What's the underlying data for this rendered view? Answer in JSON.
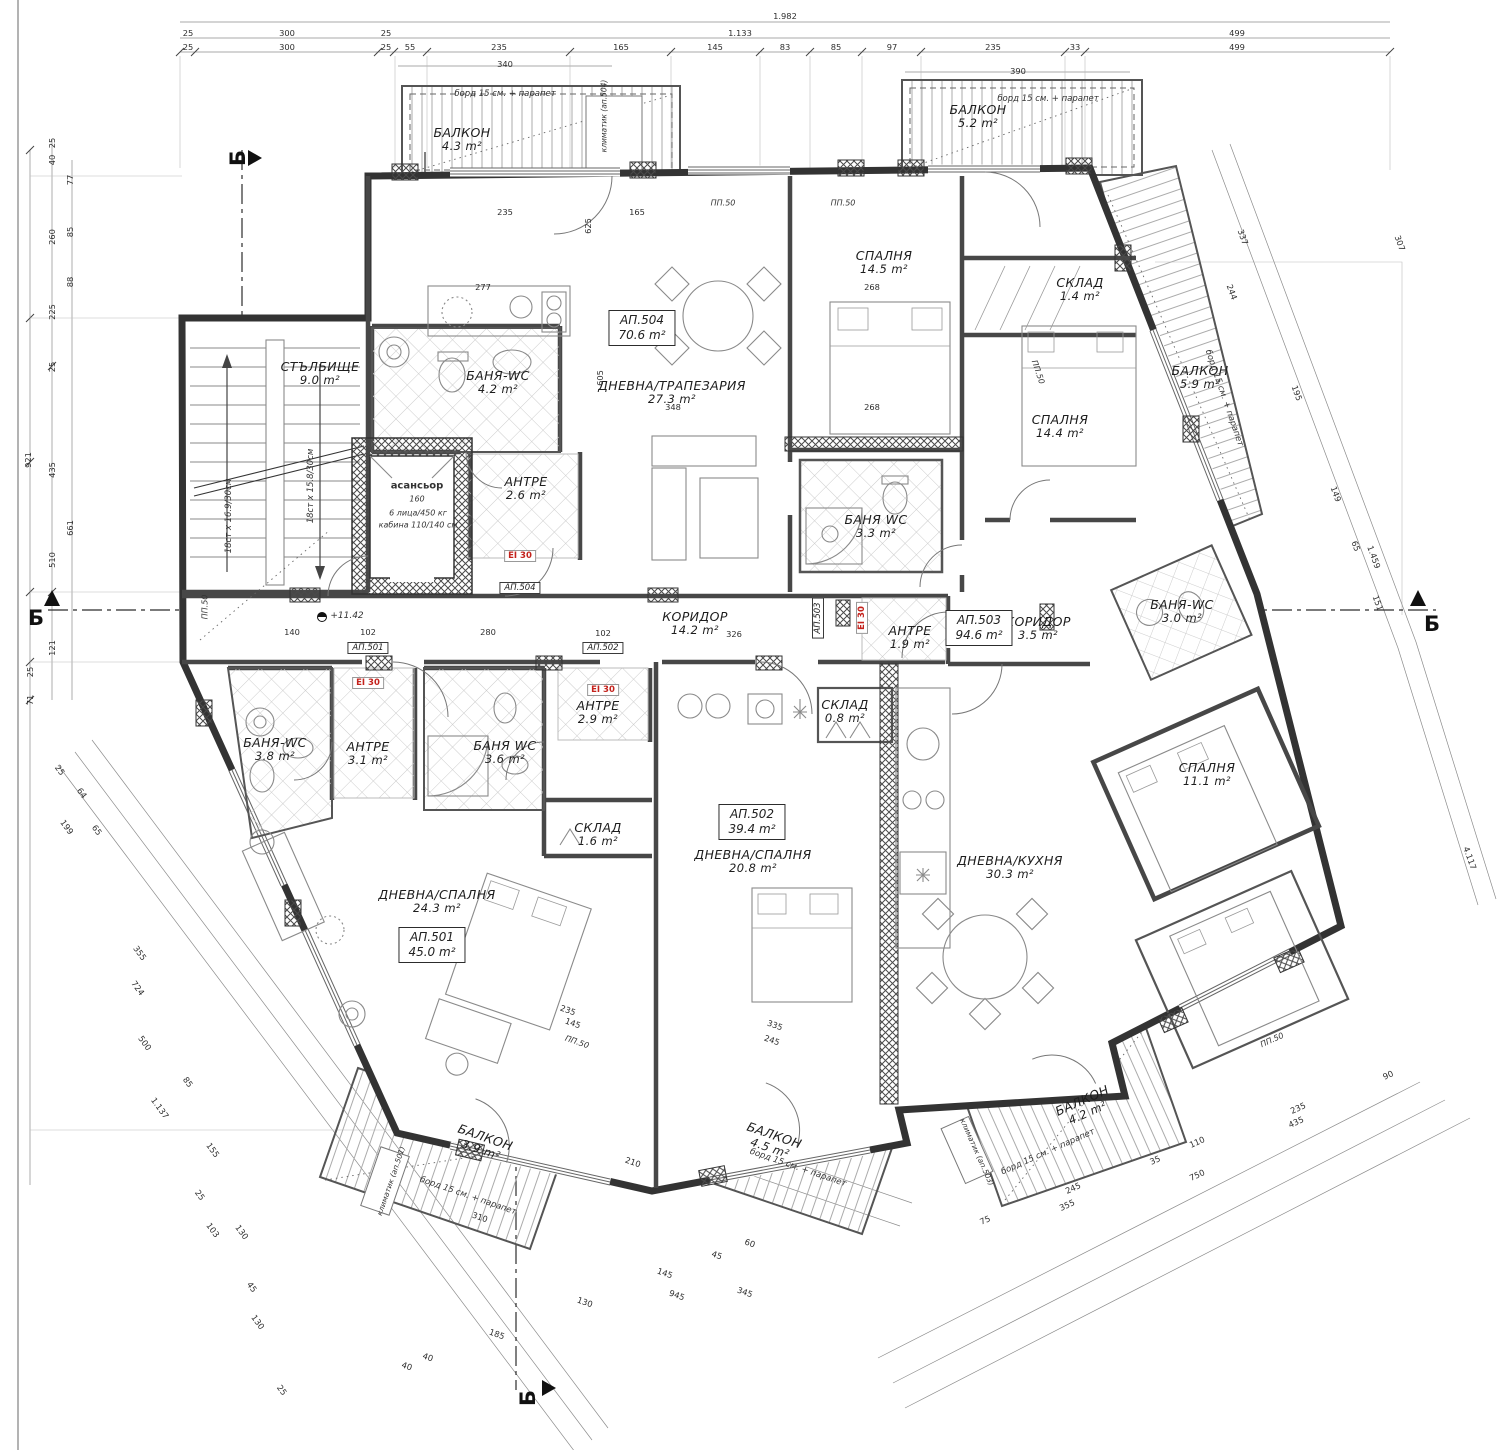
{
  "meta": {
    "section_label": "Б",
    "fire": "EI 30",
    "level": "+11.42",
    "colors": {
      "fire_red": "#c4231d",
      "wall": "#333333",
      "hatch": "#aaaaaa"
    }
  },
  "rooms": [
    {
      "n": "БАЛКОН",
      "a": "4.3 m²",
      "x": 462,
      "y": 140,
      "r": 0
    },
    {
      "n": "БАЛКОН",
      "a": "5.2 m²",
      "x": 978,
      "y": 117,
      "r": 0
    },
    {
      "n": "БАЛКОН",
      "a": "5.9 m²",
      "x": 1200,
      "y": 378,
      "r": 0
    },
    {
      "n": "СТЪЛБИЩЕ",
      "a": "9.0 m²",
      "x": 320,
      "y": 374,
      "r": 0
    },
    {
      "n": "БАНЯ-WC",
      "a": "4.2 m²",
      "x": 498,
      "y": 383,
      "r": 0
    },
    {
      "n": "АНТРЕ",
      "a": "2.6 m²",
      "x": 526,
      "y": 489,
      "r": 0
    },
    {
      "n": "ДНЕВНА/ТРАПЕЗАРИЯ",
      "a": "27.3 m²",
      "x": 672,
      "y": 393,
      "r": 0
    },
    {
      "n": "СПАЛНЯ",
      "a": "14.5 m²",
      "x": 884,
      "y": 263,
      "r": 0
    },
    {
      "n": "СКЛАД",
      "a": "1.4 m²",
      "x": 1080,
      "y": 290,
      "r": 0
    },
    {
      "n": "СПАЛНЯ",
      "a": "14.4 m²",
      "x": 1060,
      "y": 427,
      "r": 0
    },
    {
      "n": "БАНЯ WC",
      "a": "3.3 m²",
      "x": 876,
      "y": 527,
      "r": 0
    },
    {
      "n": "КОРИДОР",
      "a": "14.2 m²",
      "x": 695,
      "y": 624,
      "r": 0
    },
    {
      "n": "АНТРЕ",
      "a": "1.9 m²",
      "x": 910,
      "y": 638,
      "r": 0
    },
    {
      "n": "КОРИДОР",
      "a": "3.5 m²",
      "x": 1038,
      "y": 629,
      "r": 0
    },
    {
      "n": "БАНЯ-WC",
      "a": "3.0 m²",
      "x": 1182,
      "y": 612,
      "r": 0
    },
    {
      "n": "СПАЛНЯ",
      "a": "11.1 m²",
      "x": 1207,
      "y": 775,
      "r": 0
    },
    {
      "n": "ДНЕВНА/КУХНЯ",
      "a": "30.3 m²",
      "x": 1010,
      "y": 868,
      "r": 0
    },
    {
      "n": "СКЛАД",
      "a": "0.8 m²",
      "x": 845,
      "y": 712,
      "r": 0
    },
    {
      "n": "ДНЕВНА/СПАЛНЯ",
      "a": "20.8 m²",
      "x": 753,
      "y": 862,
      "r": 0
    },
    {
      "n": "СКЛАД",
      "a": "1.6 m²",
      "x": 598,
      "y": 835,
      "r": 0
    },
    {
      "n": "АНТРЕ",
      "a": "2.9 m²",
      "x": 598,
      "y": 713,
      "r": 0
    },
    {
      "n": "БАНЯ WC",
      "a": "3.6 m²",
      "x": 505,
      "y": 753,
      "r": 0
    },
    {
      "n": "АНТРЕ",
      "a": "3.1 m²",
      "x": 368,
      "y": 754,
      "r": 0
    },
    {
      "n": "БАНЯ-WC",
      "a": "3.8 m²",
      "x": 275,
      "y": 750,
      "r": 0
    },
    {
      "n": "ДНЕВНА/СПАЛНЯ",
      "a": "24.3 m²",
      "x": 437,
      "y": 902,
      "r": 0
    },
    {
      "n": "БАЛКОН",
      "a": "3.9 m²",
      "x": 483,
      "y": 1144,
      "r": 19
    },
    {
      "n": "БАЛКОН",
      "a": "4.5 m²",
      "x": 772,
      "y": 1142,
      "r": 19
    },
    {
      "n": "БАЛКОН",
      "a": "4.2 m²",
      "x": 1085,
      "y": 1107,
      "r": -24
    }
  ],
  "apartments": [
    {
      "id": "АП.504",
      "a": "70.6 m²",
      "x": 642,
      "y": 328
    },
    {
      "id": "АП.503",
      "a": "94.6 m²",
      "x": 979,
      "y": 628
    },
    {
      "id": "АП.502",
      "a": "39.4 m²",
      "x": 752,
      "y": 822
    },
    {
      "id": "АП.501",
      "a": "45.0 m²",
      "x": 432,
      "y": 945
    }
  ],
  "tags": [
    {
      "t": "АП.501",
      "x": 368,
      "y": 648,
      "r": 0
    },
    {
      "t": "АП.502",
      "x": 603,
      "y": 648,
      "r": 0
    },
    {
      "t": "АП.504",
      "x": 520,
      "y": 588,
      "r": 0
    },
    {
      "t": "АП.503",
      "x": 818,
      "y": 618,
      "r": -90
    }
  ],
  "fire_marks": [
    {
      "x": 520,
      "y": 556,
      "r": 0
    },
    {
      "x": 368,
      "y": 683,
      "r": 0
    },
    {
      "x": 603,
      "y": 690,
      "r": 0
    },
    {
      "x": 862,
      "y": 618,
      "r": -90
    }
  ],
  "sections": [
    {
      "x": 36,
      "y": 618,
      "r": 0
    },
    {
      "x": 1432,
      "y": 624,
      "r": 0
    },
    {
      "x": 238,
      "y": 158,
      "r": -90
    },
    {
      "x": 528,
      "y": 1398,
      "r": -90
    }
  ],
  "notes": [
    {
      "t": "борд 15 см. + парапет",
      "x": 505,
      "y": 94,
      "r": 0,
      "s": 8.5
    },
    {
      "t": "борд 15 см. + парапет",
      "x": 1048,
      "y": 99,
      "r": 0,
      "s": 8.5
    },
    {
      "t": "борд 15 см. + парапет",
      "x": 1224,
      "y": 398,
      "r": 71,
      "s": 8.5
    },
    {
      "t": "борд 15 см. + парапет",
      "x": 468,
      "y": 1196,
      "r": 19,
      "s": 8.5
    },
    {
      "t": "борд 15 см. + парапет",
      "x": 798,
      "y": 1168,
      "r": 19,
      "s": 8.5
    },
    {
      "t": "борд 15 см. + парапет",
      "x": 1048,
      "y": 1152,
      "r": -24,
      "s": 8.5
    },
    {
      "t": "климатик (ап.504)",
      "x": 604,
      "y": 116,
      "r": -90,
      "s": 7.5
    },
    {
      "t": "климатик (ап.501)",
      "x": 391,
      "y": 1181,
      "r": -71,
      "s": 7.5
    },
    {
      "t": "климатик (ап.503)",
      "x": 977,
      "y": 1152,
      "r": 66,
      "s": 7.5
    },
    {
      "t": "асансьор",
      "x": 417,
      "y": 486,
      "r": 0,
      "s": 10,
      "b": 1
    },
    {
      "t": "160",
      "x": 417,
      "y": 499,
      "r": 0,
      "s": 8
    },
    {
      "t": "6 лица/450 кг",
      "x": 418,
      "y": 513,
      "r": 0,
      "s": 8
    },
    {
      "t": "кабина 110/140 см",
      "x": 418,
      "y": 525,
      "r": 0,
      "s": 8
    },
    {
      "t": "18ст x 16.9/30см",
      "x": 229,
      "y": 516,
      "r": -90,
      "s": 8.5
    },
    {
      "t": "18ст x 15.8/30см",
      "x": 311,
      "y": 486,
      "r": -90,
      "s": 8.5
    },
    {
      "t": "+11.42",
      "x": 347,
      "y": 616,
      "r": 0,
      "s": 9
    },
    {
      "t": "ПП.50",
      "x": 723,
      "y": 203,
      "r": 0,
      "s": 8
    },
    {
      "t": "ПП.50",
      "x": 843,
      "y": 203,
      "r": 0,
      "s": 8
    },
    {
      "t": "ПП.50",
      "x": 1038,
      "y": 372,
      "r": 71,
      "s": 8
    },
    {
      "t": "ПП.50",
      "x": 577,
      "y": 1042,
      "r": 19,
      "s": 8
    },
    {
      "t": "ПП.50",
      "x": 1272,
      "y": 1040,
      "r": -24,
      "s": 8
    },
    {
      "t": "ПП.50",
      "x": 205,
      "y": 607,
      "r": -90,
      "s": 8
    }
  ],
  "dims": [
    {
      "t": "1.982",
      "x": 785,
      "y": 16,
      "r": 0
    },
    {
      "t": "25",
      "x": 188,
      "y": 33,
      "r": 0
    },
    {
      "t": "300",
      "x": 287,
      "y": 33,
      "r": 0
    },
    {
      "t": "25",
      "x": 386,
      "y": 33,
      "r": 0
    },
    {
      "t": "1.133",
      "x": 740,
      "y": 33,
      "r": 0
    },
    {
      "t": "499",
      "x": 1237,
      "y": 33,
      "r": 0
    },
    {
      "t": "25",
      "x": 188,
      "y": 47,
      "r": 0
    },
    {
      "t": "300",
      "x": 287,
      "y": 47,
      "r": 0
    },
    {
      "t": "25",
      "x": 386,
      "y": 47,
      "r": 0
    },
    {
      "t": "55",
      "x": 410,
      "y": 47,
      "r": 0
    },
    {
      "t": "235",
      "x": 499,
      "y": 47,
      "r": 0
    },
    {
      "t": "165",
      "x": 621,
      "y": 47,
      "r": 0
    },
    {
      "t": "145",
      "x": 715,
      "y": 47,
      "r": 0
    },
    {
      "t": "83",
      "x": 785,
      "y": 47,
      "r": 0
    },
    {
      "t": "85",
      "x": 836,
      "y": 47,
      "r": 0
    },
    {
      "t": "97",
      "x": 892,
      "y": 47,
      "r": 0
    },
    {
      "t": "235",
      "x": 993,
      "y": 47,
      "r": 0
    },
    {
      "t": "33",
      "x": 1075,
      "y": 47,
      "r": 0
    },
    {
      "t": "499",
      "x": 1237,
      "y": 47,
      "r": 0
    },
    {
      "t": "340",
      "x": 505,
      "y": 64,
      "r": 0
    },
    {
      "t": "390",
      "x": 1018,
      "y": 71,
      "r": 0
    },
    {
      "t": "921",
      "x": 28,
      "y": 460,
      "r": -90
    },
    {
      "t": "25",
      "x": 52,
      "y": 143,
      "r": -90
    },
    {
      "t": "40",
      "x": 52,
      "y": 160,
      "r": -90
    },
    {
      "t": "260",
      "x": 52,
      "y": 237,
      "r": -90
    },
    {
      "t": "225",
      "x": 52,
      "y": 312,
      "r": -90
    },
    {
      "t": "25",
      "x": 52,
      "y": 367,
      "r": -90
    },
    {
      "t": "435",
      "x": 52,
      "y": 470,
      "r": -90
    },
    {
      "t": "510",
      "x": 52,
      "y": 560,
      "r": -90
    },
    {
      "t": "661",
      "x": 70,
      "y": 528,
      "r": -90
    },
    {
      "t": "77",
      "x": 70,
      "y": 180,
      "r": -90
    },
    {
      "t": "85",
      "x": 70,
      "y": 232,
      "r": -90
    },
    {
      "t": "88",
      "x": 70,
      "y": 282,
      "r": -90
    },
    {
      "t": "121",
      "x": 52,
      "y": 648,
      "r": -90
    },
    {
      "t": "71",
      "x": 30,
      "y": 700,
      "r": -90
    },
    {
      "t": "25",
      "x": 30,
      "y": 672,
      "r": -90
    },
    {
      "t": "337",
      "x": 1243,
      "y": 237,
      "r": 70
    },
    {
      "t": "307",
      "x": 1400,
      "y": 243,
      "r": 70
    },
    {
      "t": "244",
      "x": 1232,
      "y": 292,
      "r": 70
    },
    {
      "t": "195",
      "x": 1297,
      "y": 393,
      "r": 70
    },
    {
      "t": "149",
      "x": 1336,
      "y": 494,
      "r": 70
    },
    {
      "t": "65",
      "x": 1356,
      "y": 546,
      "r": 70
    },
    {
      "t": "1.459",
      "x": 1374,
      "y": 557,
      "r": 70
    },
    {
      "t": "151",
      "x": 1378,
      "y": 603,
      "r": 70
    },
    {
      "t": "4.117",
      "x": 1470,
      "y": 858,
      "r": 70
    },
    {
      "t": "90",
      "x": 1388,
      "y": 1075,
      "r": -24
    },
    {
      "t": "235",
      "x": 1298,
      "y": 1108,
      "r": -24
    },
    {
      "t": "435",
      "x": 1296,
      "y": 1122,
      "r": -24
    },
    {
      "t": "110",
      "x": 1197,
      "y": 1142,
      "r": -24
    },
    {
      "t": "35",
      "x": 1155,
      "y": 1160,
      "r": -24
    },
    {
      "t": "750",
      "x": 1197,
      "y": 1175,
      "r": -24
    },
    {
      "t": "245",
      "x": 1073,
      "y": 1188,
      "r": -24
    },
    {
      "t": "355",
      "x": 1067,
      "y": 1205,
      "r": -24
    },
    {
      "t": "75",
      "x": 985,
      "y": 1220,
      "r": -24
    },
    {
      "t": "25",
      "x": 60,
      "y": 770,
      "r": 54
    },
    {
      "t": "64",
      "x": 82,
      "y": 793,
      "r": 54
    },
    {
      "t": "199",
      "x": 67,
      "y": 827,
      "r": 54
    },
    {
      "t": "65",
      "x": 97,
      "y": 830,
      "r": 54
    },
    {
      "t": "355",
      "x": 140,
      "y": 953,
      "r": 54
    },
    {
      "t": "724",
      "x": 138,
      "y": 988,
      "r": 54
    },
    {
      "t": "500",
      "x": 145,
      "y": 1043,
      "r": 54
    },
    {
      "t": "85",
      "x": 188,
      "y": 1082,
      "r": 54
    },
    {
      "t": "1.137",
      "x": 160,
      "y": 1108,
      "r": 54
    },
    {
      "t": "155",
      "x": 213,
      "y": 1150,
      "r": 54
    },
    {
      "t": "25",
      "x": 200,
      "y": 1195,
      "r": 54
    },
    {
      "t": "103",
      "x": 213,
      "y": 1230,
      "r": 54
    },
    {
      "t": "130",
      "x": 242,
      "y": 1232,
      "r": 54
    },
    {
      "t": "45",
      "x": 252,
      "y": 1287,
      "r": 54
    },
    {
      "t": "130",
      "x": 258,
      "y": 1322,
      "r": 54
    },
    {
      "t": "25",
      "x": 282,
      "y": 1390,
      "r": 54
    },
    {
      "t": "310",
      "x": 480,
      "y": 1217,
      "r": 19
    },
    {
      "t": "210",
      "x": 633,
      "y": 1162,
      "r": 19
    },
    {
      "t": "130",
      "x": 585,
      "y": 1302,
      "r": 19
    },
    {
      "t": "945",
      "x": 677,
      "y": 1295,
      "r": 19
    },
    {
      "t": "185",
      "x": 497,
      "y": 1334,
      "r": 19
    },
    {
      "t": "40",
      "x": 407,
      "y": 1366,
      "r": 19
    },
    {
      "t": "40",
      "x": 428,
      "y": 1357,
      "r": 19
    },
    {
      "t": "145",
      "x": 665,
      "y": 1273,
      "r": 19
    },
    {
      "t": "45",
      "x": 717,
      "y": 1255,
      "r": 19
    },
    {
      "t": "60",
      "x": 750,
      "y": 1243,
      "r": 19
    },
    {
      "t": "345",
      "x": 745,
      "y": 1292,
      "r": 19
    },
    {
      "t": "335",
      "x": 775,
      "y": 1025,
      "r": 19
    },
    {
      "t": "245",
      "x": 772,
      "y": 1040,
      "r": 19
    },
    {
      "t": "235",
      "x": 568,
      "y": 1010,
      "r": 19
    },
    {
      "t": "145",
      "x": 573,
      "y": 1023,
      "r": 19
    },
    {
      "t": "348",
      "x": 673,
      "y": 407,
      "r": 0
    },
    {
      "t": "268",
      "x": 872,
      "y": 407,
      "r": 0
    },
    {
      "t": "268",
      "x": 872,
      "y": 287,
      "r": 0
    },
    {
      "t": "277",
      "x": 483,
      "y": 287,
      "r": 0
    },
    {
      "t": "326",
      "x": 734,
      "y": 634,
      "r": 0
    },
    {
      "t": "102",
      "x": 603,
      "y": 633,
      "r": 0
    },
    {
      "t": "140",
      "x": 292,
      "y": 632,
      "r": 0
    },
    {
      "t": "102",
      "x": 368,
      "y": 632,
      "r": 0
    },
    {
      "t": "280",
      "x": 488,
      "y": 632,
      "r": 0
    },
    {
      "t": "235",
      "x": 505,
      "y": 212,
      "r": 0
    },
    {
      "t": "165",
      "x": 637,
      "y": 212,
      "r": 0
    },
    {
      "t": "605",
      "x": 600,
      "y": 378,
      "r": -90
    },
    {
      "t": "625",
      "x": 588,
      "y": 226,
      "r": -90
    }
  ]
}
